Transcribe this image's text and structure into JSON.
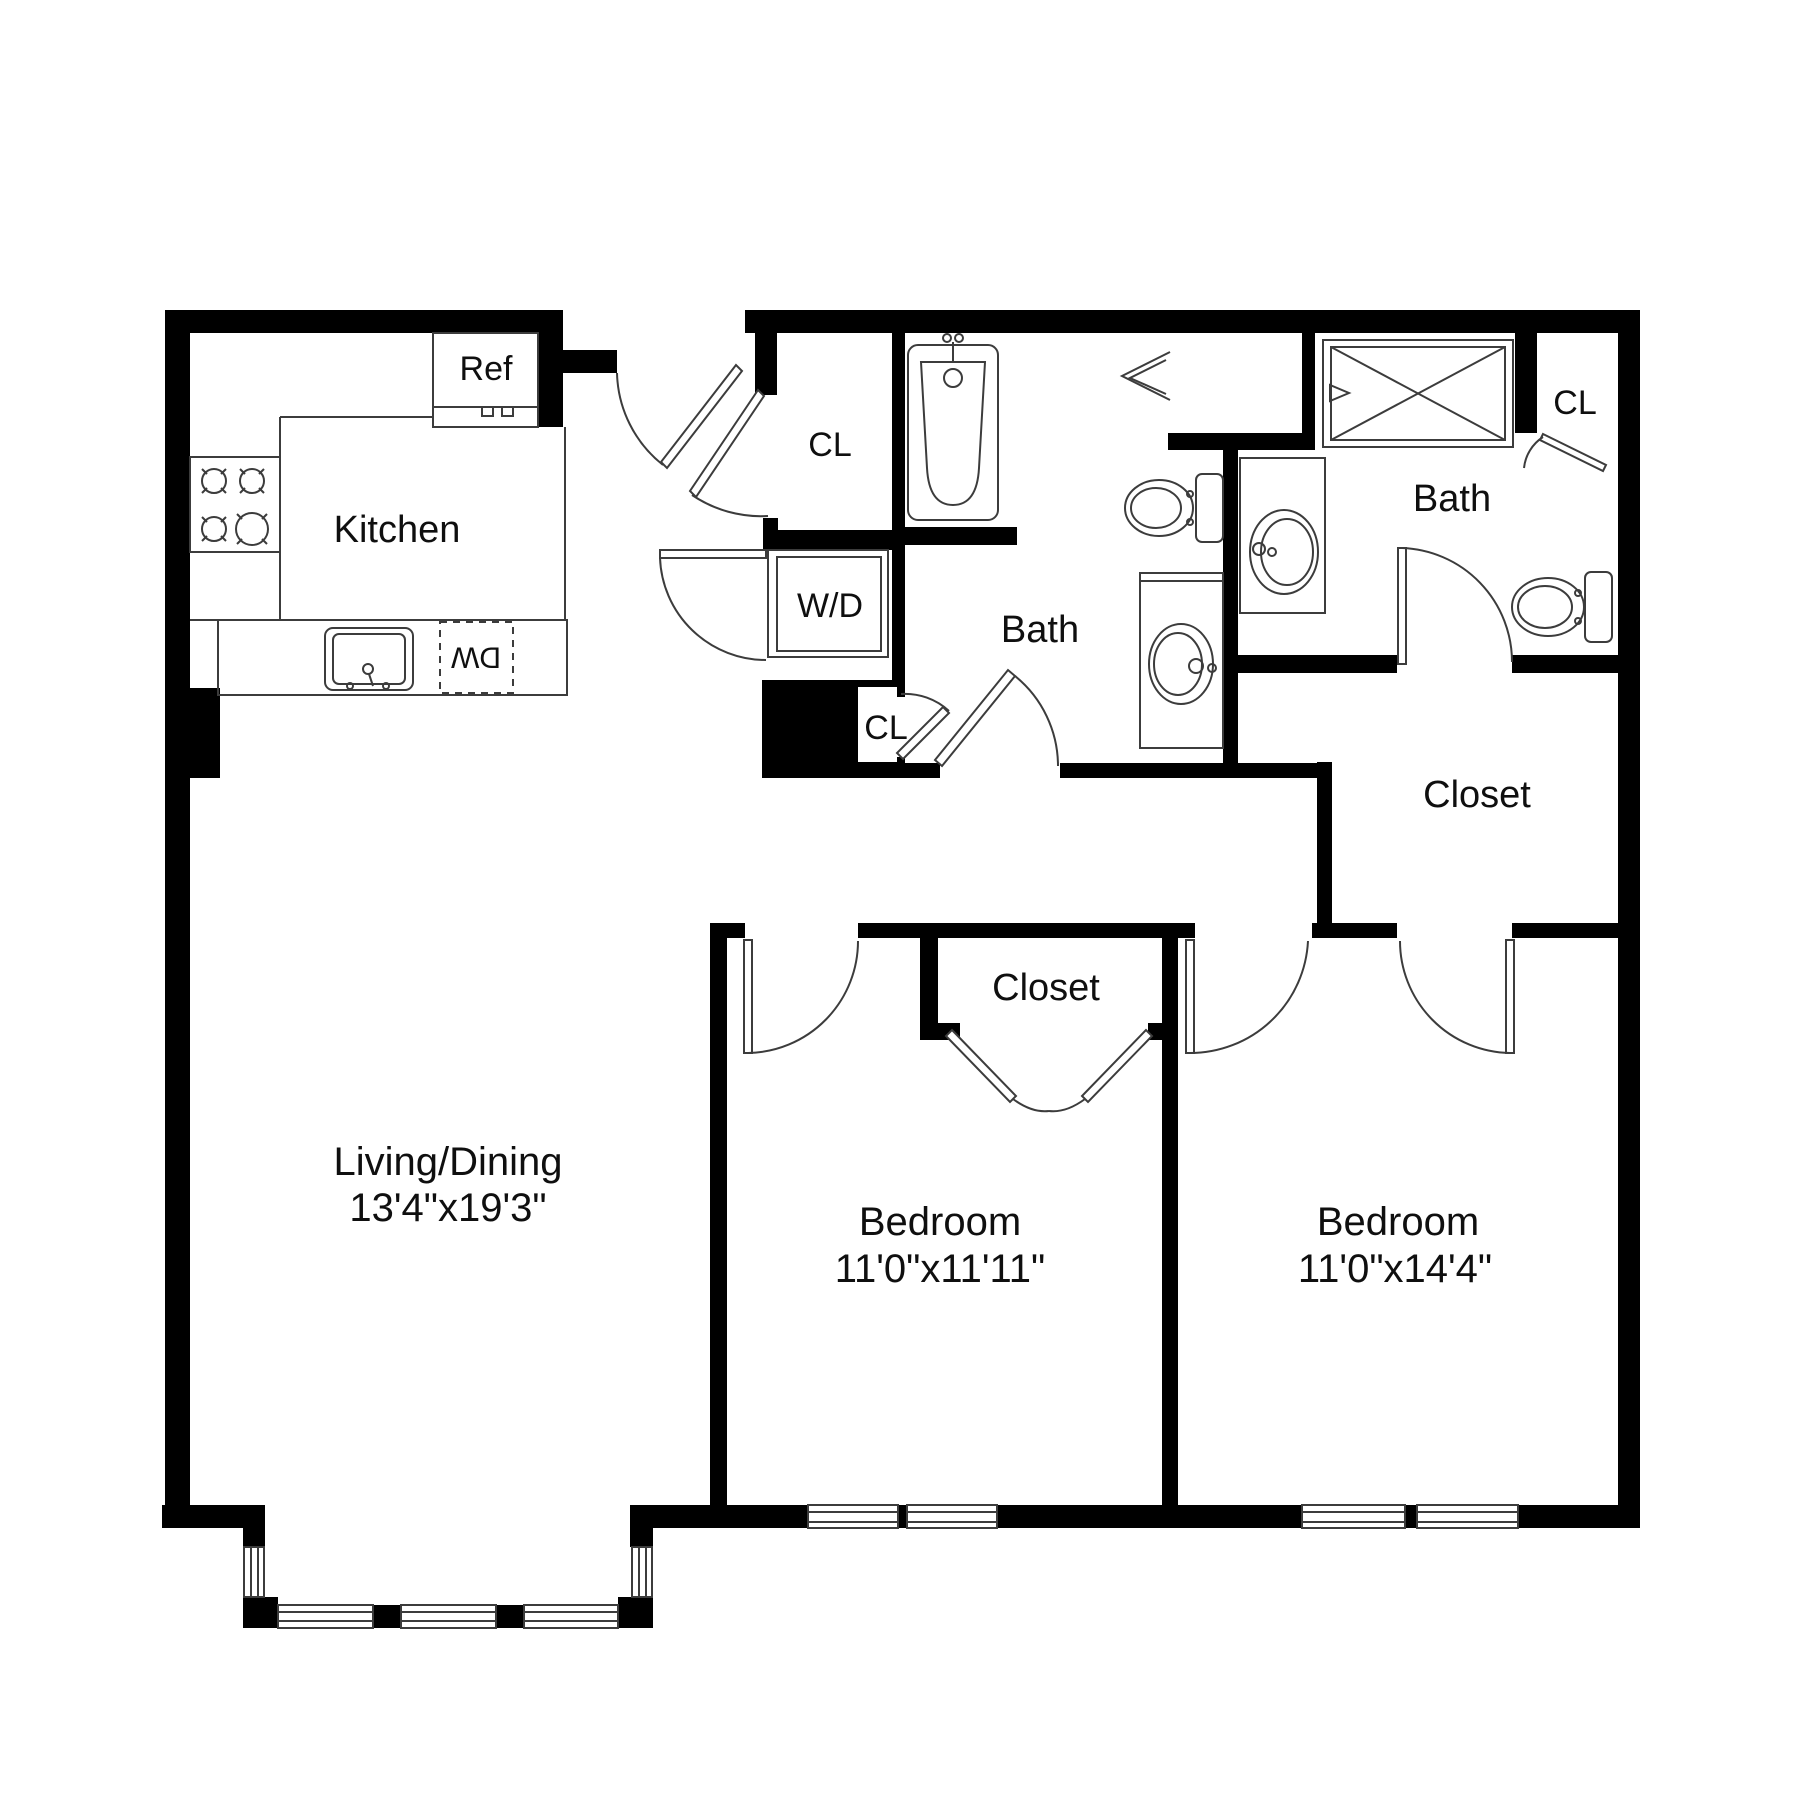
{
  "plan_type": "apartment-floor-plan",
  "colors": {
    "background": "#ffffff",
    "walls": "#000000",
    "fixture_lines": "#3c3c3c",
    "text": "#0f0f0f"
  },
  "rooms": {
    "kitchen": {
      "label": "Kitchen"
    },
    "living_dining": {
      "label": "Living/Dining",
      "dims": "13'4\"x19'3\""
    },
    "bedroom_1": {
      "label": "Bedroom",
      "dims": "11'0\"x11'11\""
    },
    "bedroom_2": {
      "label": "Bedroom",
      "dims": "11'0\"x14'4\""
    },
    "bath_center": {
      "label": "Bath"
    },
    "bath_right": {
      "label": "Bath"
    },
    "walk_in_closet": {
      "label": "Closet"
    },
    "bedroom_1_closet": {
      "label": "Closet"
    }
  },
  "closets": {
    "entry": {
      "label": "CL"
    },
    "hall": {
      "label": "CL"
    },
    "bath": {
      "label": "CL"
    }
  },
  "appliances": {
    "refrigerator": {
      "label": "Ref"
    },
    "washer_dryer": {
      "label": "W/D"
    },
    "dishwasher": {
      "label": "DW"
    }
  },
  "fixtures": [
    "stove-icon",
    "kitchen-sink-icon",
    "bathtub-icon",
    "shower-icon",
    "toilet-icon",
    "toilet-icon",
    "vanity-sink-icon",
    "vanity-sink-icon"
  ],
  "counts": {
    "bedrooms": 2,
    "bathrooms": 2,
    "windows": 9,
    "doors": 11
  }
}
